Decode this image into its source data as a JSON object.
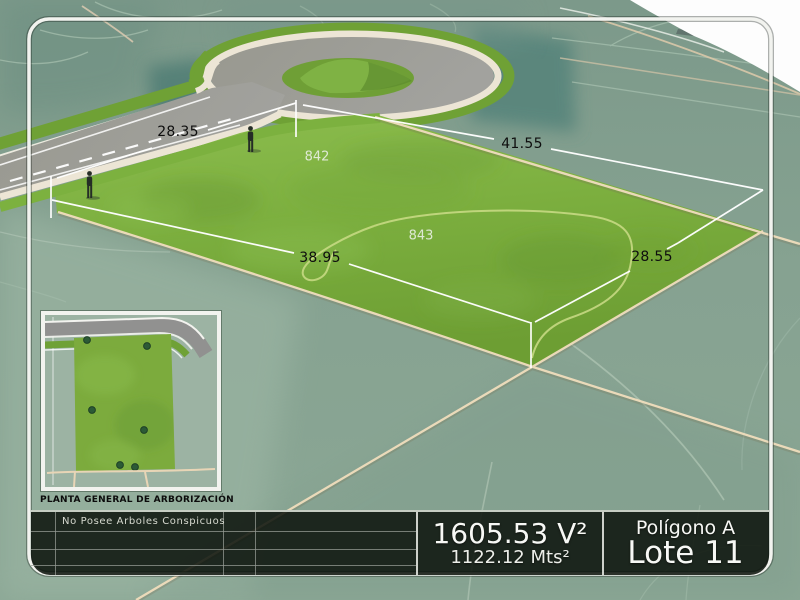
{
  "labels": {
    "dim_frontage": "28.35",
    "dim_rear": "41.55",
    "dim_side_left": "38.95",
    "dim_side_right": "28.55",
    "elevation_a": "842",
    "elevation_b": "843"
  },
  "inset": {
    "caption": "PLANTA GENERAL DE ARBORIZACIÓN"
  },
  "info_bar": {
    "tree_note": "No Posee Arboles Conspicuos",
    "area_varas": "1605.53 V²",
    "area_meters": "1122.12 Mts²",
    "polygon_name": "Polígono A",
    "lot_name": "Lote 11"
  },
  "colors": {
    "terrain_sage": "#87a292",
    "parcel_green": "#7aac3d",
    "road_gray": "#9c9c98",
    "boundary_tan": "#eedcbc",
    "dimension_white": "#ffffff",
    "bar_background": "#121812",
    "text_white": "#f5f5f2"
  }
}
